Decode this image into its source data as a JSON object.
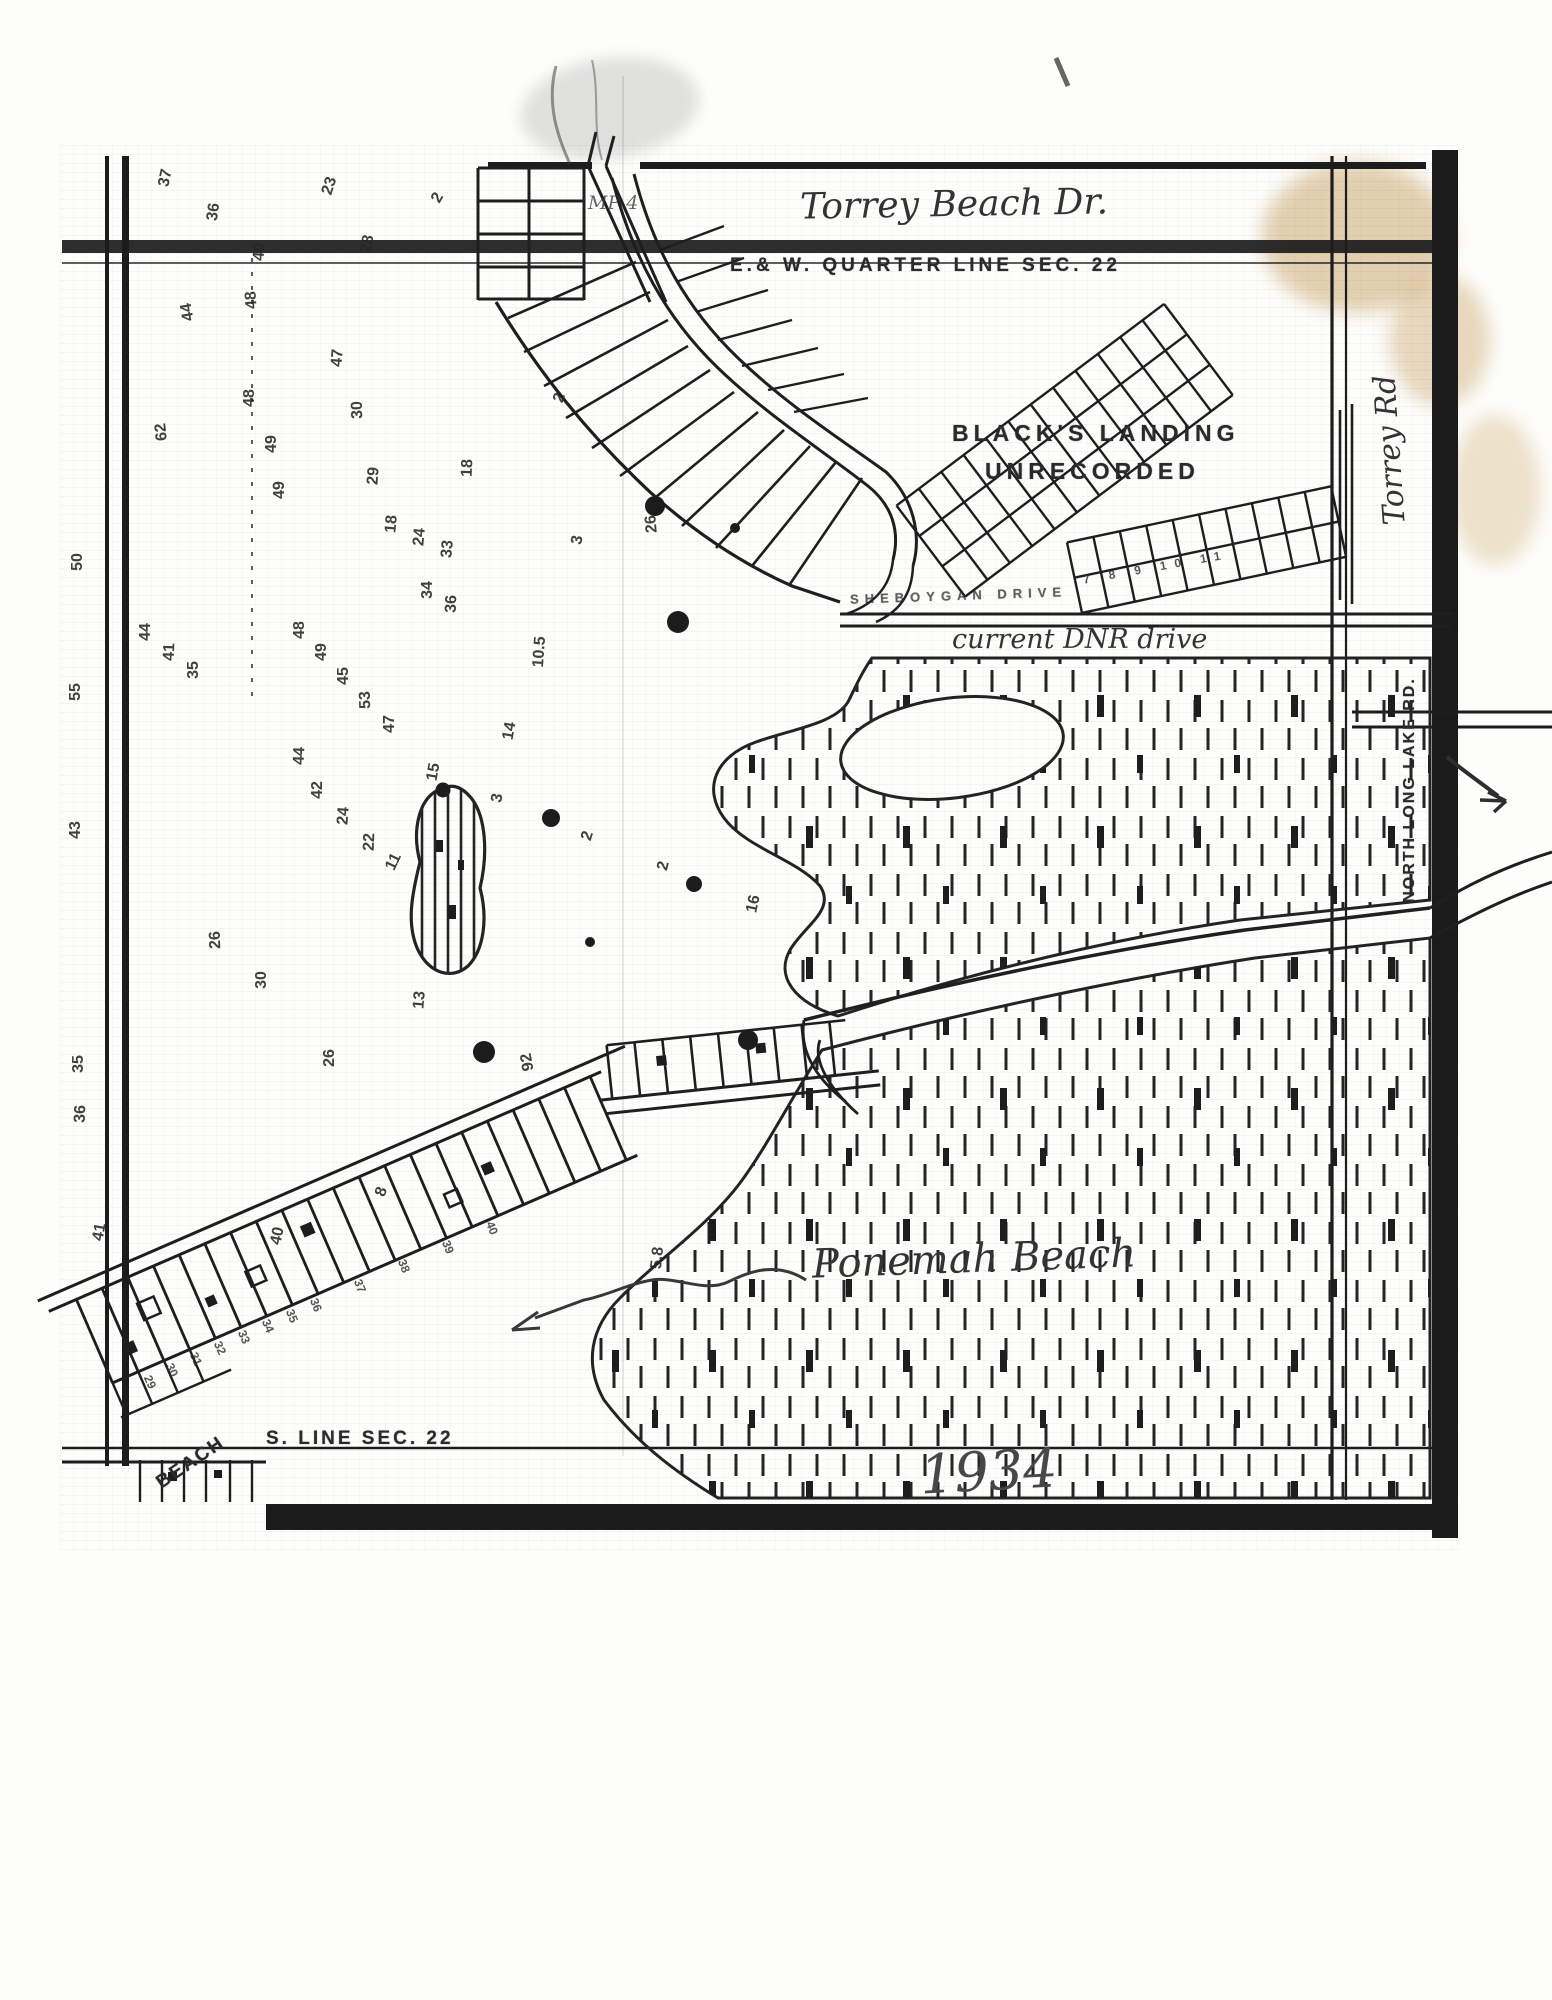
{
  "labels": {
    "torrey_beach_dr": "Torrey Beach Dr.",
    "quarter_line": "E.& W. QUARTER LINE  SEC. 22",
    "blacks_landing_1": "BLACK'S LANDING",
    "blacks_landing_2": "UNRECORDED",
    "torrey_rd": "Torrey Rd",
    "north_long_lake_rd": "NORTH LONG LAKE RD.",
    "sheboygan_drive": "SHEBOYGAN   DRIVE",
    "current_dnr_drive": "current DNR drive",
    "ponemah_beach": "Ponemah Beach",
    "s_line": "S. LINE SEC. 22",
    "beach": "BEACH",
    "year": "1934",
    "mp4": "MP 4",
    "blacks_lot_row": "7  8  9  10  11"
  },
  "colors": {
    "ink": "#1f1f1f",
    "stain": "#c7a163",
    "paper": "#fdfdfb"
  },
  "soundings": [
    {
      "v": "37",
      "x": 166,
      "y": 178,
      "r": -78
    },
    {
      "v": "36",
      "x": 214,
      "y": 212,
      "r": -82
    },
    {
      "v": "40",
      "x": 260,
      "y": 252,
      "r": -86
    },
    {
      "v": "23",
      "x": 330,
      "y": 186,
      "r": -72
    },
    {
      "v": "28",
      "x": 368,
      "y": 244,
      "r": -78
    },
    {
      "v": "2",
      "x": 438,
      "y": 198,
      "r": -60
    },
    {
      "v": "44",
      "x": 188,
      "y": 312,
      "r": -100
    },
    {
      "v": "48",
      "x": 252,
      "y": 300,
      "r": -94
    },
    {
      "v": "48",
      "x": 250,
      "y": 398,
      "r": -90
    },
    {
      "v": "47",
      "x": 338,
      "y": 358,
      "r": -86
    },
    {
      "v": "30",
      "x": 358,
      "y": 410,
      "r": -92
    },
    {
      "v": "62",
      "x": 162,
      "y": 432,
      "r": -96
    },
    {
      "v": "49",
      "x": 272,
      "y": 444,
      "r": -90
    },
    {
      "v": "49",
      "x": 280,
      "y": 490,
      "r": -92
    },
    {
      "v": "29",
      "x": 374,
      "y": 476,
      "r": -86
    },
    {
      "v": "18",
      "x": 468,
      "y": 468,
      "r": -88
    },
    {
      "v": "2",
      "x": 560,
      "y": 398,
      "r": -70
    },
    {
      "v": "3",
      "x": 578,
      "y": 540,
      "r": -80
    },
    {
      "v": "26",
      "x": 652,
      "y": 524,
      "r": -95
    },
    {
      "v": "10.5",
      "x": 540,
      "y": 652,
      "r": -86
    },
    {
      "v": "18",
      "x": 392,
      "y": 524,
      "r": -85
    },
    {
      "v": "24",
      "x": 420,
      "y": 537,
      "r": -85
    },
    {
      "v": "33",
      "x": 448,
      "y": 549,
      "r": -85
    },
    {
      "v": "34",
      "x": 428,
      "y": 590,
      "r": -90
    },
    {
      "v": "36",
      "x": 452,
      "y": 604,
      "r": -88
    },
    {
      "v": "44",
      "x": 146,
      "y": 632,
      "r": -90
    },
    {
      "v": "41",
      "x": 170,
      "y": 652,
      "r": -88
    },
    {
      "v": "35",
      "x": 194,
      "y": 670,
      "r": -90
    },
    {
      "v": "48",
      "x": 300,
      "y": 630,
      "r": -90
    },
    {
      "v": "49",
      "x": 322,
      "y": 652,
      "r": -90
    },
    {
      "v": "45",
      "x": 344,
      "y": 676,
      "r": -90
    },
    {
      "v": "53",
      "x": 366,
      "y": 700,
      "r": -92
    },
    {
      "v": "47",
      "x": 390,
      "y": 724,
      "r": -90
    },
    {
      "v": "44",
      "x": 300,
      "y": 756,
      "r": -88
    },
    {
      "v": "42",
      "x": 318,
      "y": 790,
      "r": -90
    },
    {
      "v": "24",
      "x": 344,
      "y": 816,
      "r": -86
    },
    {
      "v": "22",
      "x": 370,
      "y": 842,
      "r": -88
    },
    {
      "v": "14",
      "x": 510,
      "y": 731,
      "r": -80
    },
    {
      "v": "11",
      "x": 394,
      "y": 862,
      "r": -64
    },
    {
      "v": "15",
      "x": 434,
      "y": 772,
      "r": -80
    },
    {
      "v": "3",
      "x": 498,
      "y": 798,
      "r": -80
    },
    {
      "v": "2",
      "x": 588,
      "y": 836,
      "r": -72
    },
    {
      "v": "2",
      "x": 664,
      "y": 866,
      "r": -76
    },
    {
      "v": "16",
      "x": 754,
      "y": 904,
      "r": -78
    },
    {
      "v": "13",
      "x": 420,
      "y": 1000,
      "r": -85
    },
    {
      "v": "26",
      "x": 330,
      "y": 1058,
      "r": -90
    },
    {
      "v": "92",
      "x": 528,
      "y": 1062,
      "r": -100
    },
    {
      "v": "26",
      "x": 216,
      "y": 940,
      "r": -92
    },
    {
      "v": "30",
      "x": 262,
      "y": 980,
      "r": -90
    },
    {
      "v": "8",
      "x": 382,
      "y": 1192,
      "r": -70
    },
    {
      "v": "40",
      "x": 278,
      "y": 1236,
      "r": -78
    },
    {
      "v": "41",
      "x": 100,
      "y": 1232,
      "r": -80
    },
    {
      "v": "5.8",
      "x": 658,
      "y": 1258,
      "r": -84
    },
    {
      "v": "50",
      "x": 78,
      "y": 562,
      "r": -90
    },
    {
      "v": "55",
      "x": 76,
      "y": 692,
      "r": -90
    },
    {
      "v": "43",
      "x": 76,
      "y": 830,
      "r": -90
    },
    {
      "v": "35",
      "x": 79,
      "y": 1064,
      "r": -90
    },
    {
      "v": "36",
      "x": 81,
      "y": 1114,
      "r": -88
    }
  ],
  "beach_lots": [
    {
      "v": "29",
      "x": 150,
      "y": 1382,
      "r": 66
    },
    {
      "v": "30",
      "x": 172,
      "y": 1370,
      "r": 66
    },
    {
      "v": "31",
      "x": 196,
      "y": 1359,
      "r": 66
    },
    {
      "v": "32",
      "x": 220,
      "y": 1348,
      "r": 66
    },
    {
      "v": "33",
      "x": 244,
      "y": 1337,
      "r": 67
    },
    {
      "v": "34",
      "x": 268,
      "y": 1326,
      "r": 67
    },
    {
      "v": "35",
      "x": 292,
      "y": 1316,
      "r": 68
    },
    {
      "v": "36",
      "x": 316,
      "y": 1305,
      "r": 68
    },
    {
      "v": "37",
      "x": 360,
      "y": 1286,
      "r": 68
    },
    {
      "v": "38",
      "x": 404,
      "y": 1266,
      "r": 68
    },
    {
      "v": "39",
      "x": 448,
      "y": 1247,
      "r": 69
    },
    {
      "v": "40",
      "x": 492,
      "y": 1228,
      "r": 69
    }
  ],
  "dots": [
    {
      "x": 655,
      "y": 506,
      "d": 20
    },
    {
      "x": 678,
      "y": 622,
      "d": 22
    },
    {
      "x": 443,
      "y": 790,
      "d": 15
    },
    {
      "x": 551,
      "y": 818,
      "d": 18
    },
    {
      "x": 694,
      "y": 884,
      "d": 16
    },
    {
      "x": 748,
      "y": 1040,
      "d": 20
    },
    {
      "x": 484,
      "y": 1052,
      "d": 22
    },
    {
      "x": 590,
      "y": 942,
      "d": 10
    },
    {
      "x": 735,
      "y": 528,
      "d": 10
    }
  ]
}
